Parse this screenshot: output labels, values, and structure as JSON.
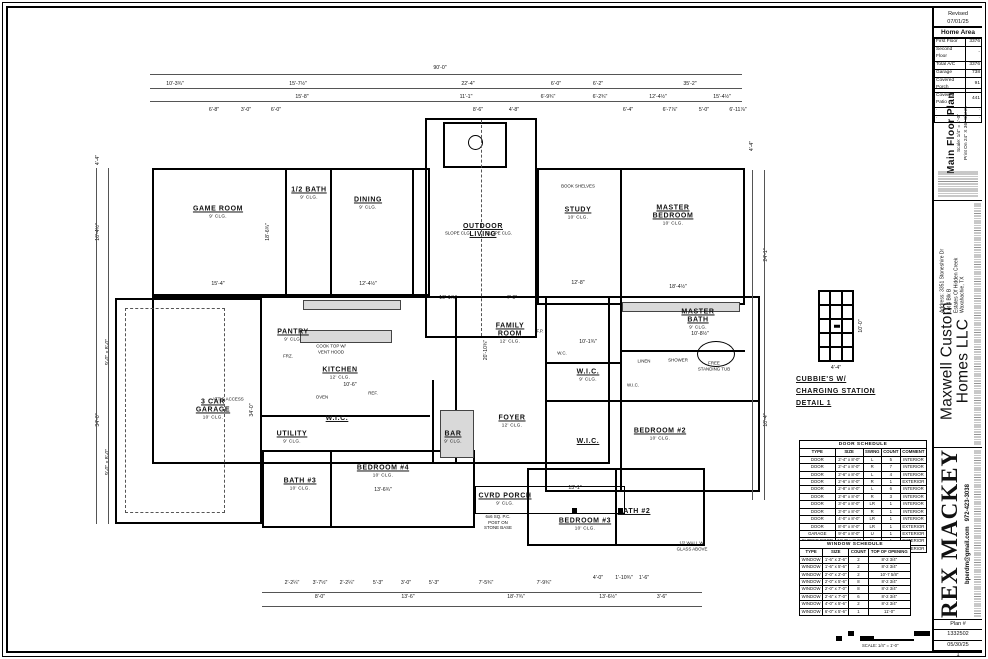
{
  "revision": {
    "label": "Revised",
    "date": "07/01/25"
  },
  "home_area": {
    "title": "Home Area",
    "rows": [
      [
        "First Floor",
        "3376"
      ],
      [
        "Second Floor",
        "-"
      ],
      [
        "Total A/C",
        "3376"
      ],
      [
        "Garage",
        "738"
      ],
      [
        "Covered Porch",
        "91"
      ],
      [
        "Covered Patio",
        "441"
      ],
      [
        "·",
        "·"
      ],
      [
        "·",
        "·"
      ]
    ]
  },
  "titleblock": {
    "sheet_title": "Main Floor Plan",
    "sheet_scale": "Scale: 1/4\" = 1'-0\"",
    "sheet_print": "Print On 24\" X 36\" Sheet.",
    "builder": "Maxwell Custom Homes LLC",
    "address_lines": [
      "Address: 3351 Stoneshire Dr",
      "Lot 4 Blk B",
      "Estates Of Hidden Creek",
      "Waxahachie, TX"
    ],
    "designer": "REX MACKEY",
    "designer_email": "bperdm@gmail.com",
    "designer_phone": "972-423-3038",
    "plan_label": "Plan #",
    "plan_number": "1332502",
    "plan_date": "05/30/25",
    "sheet_number": "1",
    "scalebar_label": "SCALE: 1/4\" = 1'-0\""
  },
  "detail": {
    "line1": "CUBBIE'S W/",
    "line2": "CHARGING STATION",
    "line3": "DETAIL 1",
    "width_dim": "4'-4\"",
    "height_dim": "10'-0\""
  },
  "door_schedule": {
    "caption": "DOOR SCHEDULE",
    "headers": [
      "TYPE",
      "SIZE",
      "SWING",
      "COUNT",
      "COMMENT"
    ],
    "rows": [
      [
        "DOOR",
        "2'-4\" x 8'-0\"",
        "L",
        "5",
        "INTERIOR"
      ],
      [
        "DOOR",
        "2'-4\" x 8'-0\"",
        "R",
        "7",
        "INTERIOR"
      ],
      [
        "DOOR",
        "2'-6\" x 8'-0\"",
        "L",
        "4",
        "INTERIOR"
      ],
      [
        "DOOR",
        "2'-6\" x 8'-0\"",
        "R",
        "1",
        "EXTERIOR"
      ],
      [
        "DOOR",
        "2'-8\" x 8'-0\"",
        "L",
        "6",
        "INTERIOR"
      ],
      [
        "DOOR",
        "2'-8\" x 8'-0\"",
        "R",
        "3",
        "INTERIOR"
      ],
      [
        "DOOR",
        "3'-0\" x 8'-0\"",
        "LR",
        "1",
        "INTERIOR"
      ],
      [
        "DOOR",
        "3'-0\" x 8'-0\"",
        "R",
        "1",
        "INTERIOR"
      ],
      [
        "DOOR",
        "4'-0\" x 8'-0\"",
        "LR",
        "1",
        "INTERIOR"
      ],
      [
        "DOOR",
        "8'-0\" x 8'-0\"",
        "LR",
        "1",
        "EXTERIOR"
      ],
      [
        "GARAGE",
        "9'-0\" x 8'-0\"",
        "U",
        "1",
        "EXTERIOR"
      ],
      [
        "SLIDING DOOR",
        "12'-0\" x 8'-0\"",
        "SL",
        "1",
        "EXTERIOR"
      ],
      [
        "GARAGE",
        "18'-0\" x 8'-0\"",
        "U",
        "1",
        "EXTERIOR"
      ]
    ]
  },
  "window_schedule": {
    "caption": "WINDOW SCHEDULE",
    "headers": [
      "TYPE",
      "SIZE",
      "COUNT",
      "TOP OF OPENING"
    ],
    "rows": [
      [
        "WINDOW",
        "1'-6\" x 3'-6\"",
        "2",
        "8'-2 3/4\""
      ],
      [
        "WINDOW",
        "1'-6\" x 5'-6\"",
        "2",
        "8'-2 3/4\""
      ],
      [
        "WINDOW",
        "2'-0\" x 2'-0\"",
        "2",
        "10'-7 5/8\""
      ],
      [
        "WINDOW",
        "2'-0\" x 5'-6\"",
        "8",
        "8'-2 3/4\""
      ],
      [
        "WINDOW",
        "2'-0\" x 7'-0\"",
        "8",
        "8'-2 3/4\""
      ],
      [
        "WINDOW",
        "2'-6\" x 7'-0\"",
        "6",
        "8'-2 3/4\""
      ],
      [
        "WINDOW",
        "4'-0\" x 5'-6\"",
        "2",
        "8'-2 3/4\""
      ],
      [
        "WINDOW",
        "6'-0\" x 5'-6\"",
        "1",
        "11'-0\""
      ]
    ]
  },
  "plan": {
    "rooms": [
      {
        "label": "GAME ROOM",
        "sub": "9' CLG.",
        "x": 218,
        "y": 212
      },
      {
        "label": "1/2 BATH",
        "sub": "9' CLG.",
        "x": 309,
        "y": 193
      },
      {
        "label": "DINING",
        "sub": "9' CLG.",
        "x": 368,
        "y": 203
      },
      {
        "label": "OUTDOOR|LIVING",
        "sub": "",
        "x": 483,
        "y": 231
      },
      {
        "label": "STUDY",
        "sub": "10' CLG.",
        "x": 578,
        "y": 213
      },
      {
        "label": "MASTER|BEDROOM",
        "sub": "10' CLG.",
        "x": 673,
        "y": 215
      },
      {
        "label": "PANTRY",
        "sub": "9' CLG.",
        "x": 293,
        "y": 335
      },
      {
        "label": "KITCHEN",
        "sub": "12' CLG.",
        "x": 340,
        "y": 373
      },
      {
        "label": "FAMILY|ROOM",
        "sub": "12' CLG.",
        "x": 510,
        "y": 333
      },
      {
        "label": "FOYER",
        "sub": "12' CLG.",
        "x": 512,
        "y": 421
      },
      {
        "label": "BAR",
        "sub": "9' CLG.",
        "x": 453,
        "y": 437
      },
      {
        "label": "W.I.C.",
        "sub": "",
        "x": 337,
        "y": 419
      },
      {
        "label": "UTILITY",
        "sub": "9' CLG.",
        "x": 292,
        "y": 437
      },
      {
        "label": "3 CAR|GARAGE",
        "sub": "10' CLG.",
        "x": 213,
        "y": 409
      },
      {
        "label": "BEDROOM #4",
        "sub": "10' CLG.",
        "x": 383,
        "y": 471
      },
      {
        "label": "BATH #3",
        "sub": "10' CLG.",
        "x": 300,
        "y": 484
      },
      {
        "label": "CVRD PORCH",
        "sub": "9' CLG.",
        "x": 505,
        "y": 499
      },
      {
        "label": "MASTER|BATH",
        "sub": "9' CLG.",
        "x": 698,
        "y": 319
      },
      {
        "label": "W.I.C.",
        "sub": "9' CLG.",
        "x": 588,
        "y": 375
      },
      {
        "label": "W.I.C.",
        "sub": "",
        "x": 588,
        "y": 442
      },
      {
        "label": "BEDROOM #2",
        "sub": "10' CLG.",
        "x": 660,
        "y": 434
      },
      {
        "label": "BEDROOM #3",
        "sub": "10' CLG.",
        "x": 585,
        "y": 524
      },
      {
        "label": "BATH #2",
        "sub": "",
        "x": 634,
        "y": 512
      }
    ],
    "dims": [
      [
        "90'-0\"",
        440,
        68,
        0
      ],
      [
        "10'-3¾\"",
        175,
        84,
        0
      ],
      [
        "15'-7½\"",
        298,
        84,
        0
      ],
      [
        "22'-4\"",
        468,
        84,
        0
      ],
      [
        "6'-0\"",
        556,
        84,
        0
      ],
      [
        "6'-2\"",
        598,
        84,
        0
      ],
      [
        "35'-2\"",
        690,
        84,
        0
      ],
      [
        "15'-8\"",
        302,
        97,
        0
      ],
      [
        "11'-1\"",
        466,
        97,
        0
      ],
      [
        "6'-9¾\"",
        548,
        97,
        0
      ],
      [
        "6'-2¾\"",
        600,
        97,
        0
      ],
      [
        "12'-4½\"",
        658,
        97,
        0
      ],
      [
        "15'-4½\"",
        722,
        97,
        0
      ],
      [
        "6'-8\"",
        214,
        110,
        0
      ],
      [
        "3'-0\"",
        246,
        110,
        0
      ],
      [
        "6'-0\"",
        276,
        110,
        0
      ],
      [
        "8'-6\"",
        478,
        110,
        0
      ],
      [
        "4'-8\"",
        514,
        110,
        0
      ],
      [
        "6'-4\"",
        628,
        110,
        0
      ],
      [
        "6'-7⅞\"",
        670,
        110,
        0
      ],
      [
        "5'-0\"",
        704,
        110,
        0
      ],
      [
        "6'-11⅞\"",
        738,
        110,
        0
      ],
      [
        "4'-4\"",
        98,
        160,
        1
      ],
      [
        "16'-4½\"",
        98,
        232,
        1
      ],
      [
        "34'-0\"",
        98,
        420,
        1
      ],
      [
        "9'-0\" x 8'-0\"",
        108,
        352,
        1
      ],
      [
        "9'-0\" x 8'-0\"",
        108,
        462,
        1
      ],
      [
        "4'-4\"",
        752,
        146,
        1
      ],
      [
        "24'-1\"",
        766,
        255,
        1
      ],
      [
        "10'-4\"",
        766,
        420,
        1
      ],
      [
        "15'-4\"",
        218,
        284,
        0
      ],
      [
        "12'-4½\"",
        368,
        284,
        0
      ],
      [
        "12'-8\"",
        578,
        283,
        0
      ],
      [
        "18'-4½\"",
        678,
        287,
        0
      ],
      [
        "18'-6¾\"",
        268,
        232,
        1
      ],
      [
        "20'-10¾\"",
        486,
        350,
        1
      ],
      [
        "10'-6\"",
        350,
        385,
        0
      ],
      [
        "34'-0\"",
        252,
        410,
        1
      ],
      [
        "13'-6¾\"",
        383,
        490,
        0
      ],
      [
        "13'-1\"",
        575,
        488,
        0
      ],
      [
        "10'-8½\"",
        700,
        334,
        0
      ],
      [
        "10'-1¾\"",
        588,
        342,
        0
      ],
      [
        "10'-1⅞\"",
        448,
        298,
        0
      ],
      [
        "7'-0\"",
        512,
        298,
        0
      ],
      [
        "2'-2¼\"",
        292,
        583,
        0
      ],
      [
        "3'-7½\"",
        320,
        583,
        0
      ],
      [
        "2'-2¼\"",
        347,
        583,
        0
      ],
      [
        "5'-3\"",
        378,
        583,
        0
      ],
      [
        "3'-0\"",
        406,
        583,
        0
      ],
      [
        "5'-3\"",
        434,
        583,
        0
      ],
      [
        "7'-5¾\"",
        486,
        583,
        0
      ],
      [
        "7'-9¾\"",
        544,
        583,
        0
      ],
      [
        "4'-0\"",
        598,
        578,
        0
      ],
      [
        "1'-10¾\"",
        624,
        578,
        0
      ],
      [
        "1'-6\"",
        644,
        578,
        0
      ],
      [
        "8'-0\"",
        320,
        597,
        0
      ],
      [
        "13'-6\"",
        408,
        597,
        0
      ],
      [
        "18'-7¾\"",
        516,
        597,
        0
      ],
      [
        "13'-6½\"",
        608,
        597,
        0
      ],
      [
        "3'-6\"",
        662,
        597,
        0
      ]
    ],
    "notes": [
      [
        "ATTIC ACCESS",
        228,
        399
      ],
      [
        "BOOK SHELVES",
        578,
        186
      ],
      [
        "COOK TOP W/ VENT HOOD",
        331,
        349
      ],
      [
        "OVEN",
        322,
        397
      ],
      [
        "REF.",
        373,
        393
      ],
      [
        "FRZ.",
        288,
        356
      ],
      [
        "LINEN",
        644,
        361
      ],
      [
        "SLOPE CLG.",
        458,
        233
      ],
      [
        "SLOPE CLG.",
        499,
        233
      ],
      [
        "6x6 SQ. P.C. POST ON STONE BASE",
        498,
        522
      ],
      [
        "1/2 WALL W/ GLASS ABOVE",
        692,
        546
      ],
      [
        "FREE STANDING TUB",
        714,
        366
      ],
      [
        "SHOWER",
        678,
        360
      ],
      [
        "F.P.",
        540,
        331
      ],
      [
        "W.C.",
        562,
        353
      ],
      [
        "W.I.C.",
        633,
        385
      ]
    ],
    "walls": [
      [
        152,
        168,
        278,
        128,
        0
      ],
      [
        425,
        118,
        112,
        220,
        0
      ],
      [
        537,
        168,
        208,
        137,
        0
      ],
      [
        152,
        296,
        458,
        168,
        0
      ],
      [
        115,
        298,
        147,
        226,
        0
      ],
      [
        545,
        296,
        215,
        196,
        0
      ],
      [
        262,
        450,
        213,
        78,
        0
      ],
      [
        527,
        468,
        178,
        78,
        0
      ],
      [
        475,
        486,
        150,
        28,
        1
      ],
      [
        443,
        122,
        64,
        46,
        0
      ]
    ],
    "plines": [
      [
        285,
        168,
        128,
        "v"
      ],
      [
        330,
        168,
        128,
        "v"
      ],
      [
        412,
        168,
        128,
        "v"
      ],
      [
        620,
        170,
        133,
        "v"
      ],
      [
        455,
        296,
        168,
        "v"
      ],
      [
        620,
        296,
        196,
        "v"
      ],
      [
        545,
        400,
        215,
        "h"
      ],
      [
        620,
        350,
        125,
        "h"
      ],
      [
        330,
        450,
        78,
        "v"
      ],
      [
        615,
        468,
        78,
        "v"
      ],
      [
        262,
        415,
        168,
        "h"
      ],
      [
        432,
        380,
        84,
        "v"
      ],
      [
        545,
        362,
        75,
        "h"
      ]
    ],
    "fills": [
      [
        303,
        300,
        98,
        10
      ],
      [
        300,
        330,
        92,
        13
      ],
      [
        440,
        410,
        34,
        48
      ],
      [
        622,
        302,
        118,
        10
      ]
    ]
  }
}
